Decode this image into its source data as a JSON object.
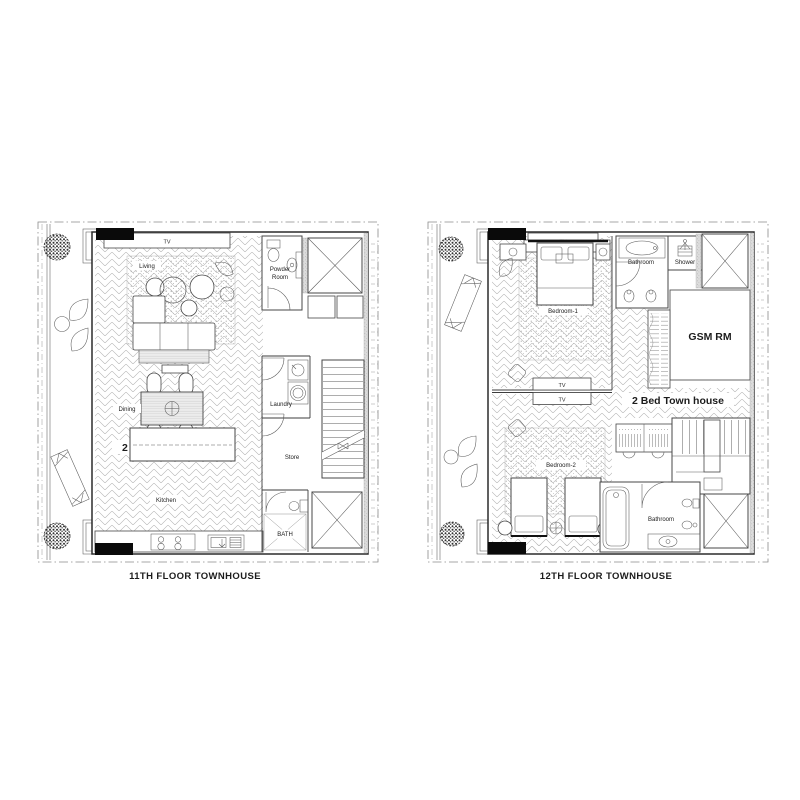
{
  "figure": {
    "type": "architectural-floor-plans",
    "background": "#ffffff",
    "line_color": "#3c3c3c"
  },
  "plans": [
    {
      "caption": "11TH FLOOR TOWNHOUSE",
      "unit_label": "2 Bed Town house",
      "labels": {
        "tv": "TV",
        "living": "Living",
        "powder_line1": "Powder",
        "powder_line2": "Room",
        "dining": "Dining",
        "laundry": "Laundry",
        "store": "Store",
        "kitchen": "Kitchen",
        "bath": "BATH"
      }
    },
    {
      "caption": "12TH FLOOR TOWNHOUSE",
      "unit_label": "2 Bed Town house",
      "labels": {
        "tv": "TV",
        "bedroom1": "Bedroom-1",
        "bathroom_upper": "Bathroom",
        "shower": "Shower",
        "gsm": "GSM RM",
        "tv_mid1": "TV",
        "tv_mid2": "TV",
        "bedroom2": "Bedroom-2",
        "bathroom_lower": "Bathroom"
      }
    }
  ]
}
